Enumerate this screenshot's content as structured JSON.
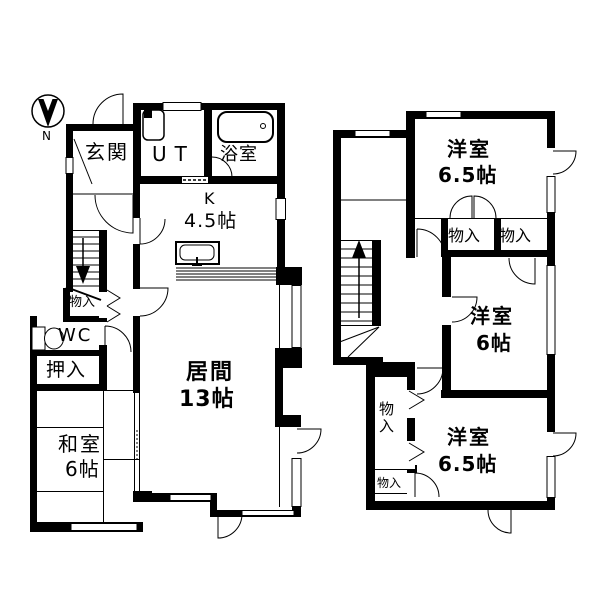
{
  "compass": {
    "label": "N"
  },
  "floor1": {
    "genkan": "玄関",
    "ut": "UT",
    "bath": "浴室",
    "kitchen_name": "K",
    "kitchen_size": "4.5帖",
    "living_name": "居間",
    "living_size": "13帖",
    "stair_storage": "物入",
    "wc": "WC",
    "oshiire": "押入",
    "washitsu_name": "和室",
    "washitsu_size": "6帖"
  },
  "floor2": {
    "room1_name": "洋室",
    "room1_size": "6.5帖",
    "closet_a": "物入",
    "closet_b": "物入",
    "room2_name": "洋室",
    "room2_size": "6帖",
    "closet_tall": "物入",
    "closet_small": "物入",
    "room3_name": "洋室",
    "room3_size": "6.5帖"
  }
}
